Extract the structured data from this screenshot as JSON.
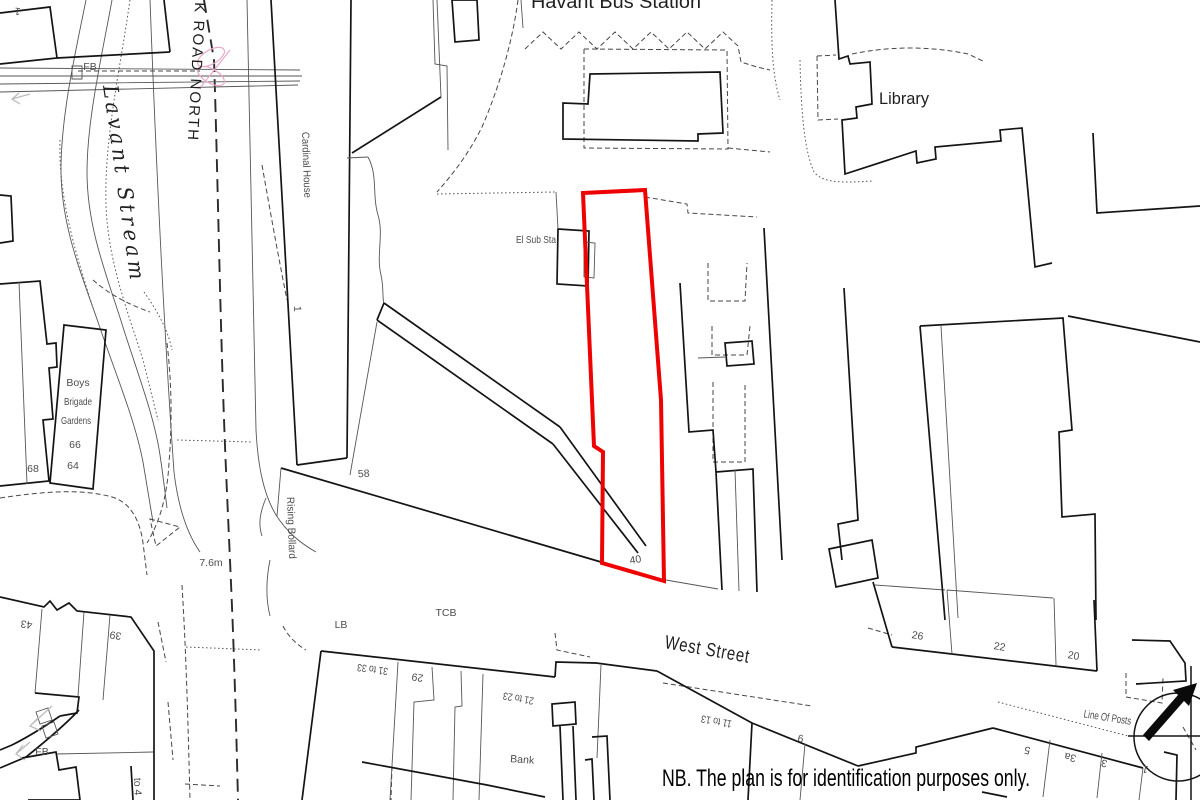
{
  "map": {
    "site_boundary_color": "#ee0202",
    "labels": [
      {
        "id": "havant-bus-station",
        "text": "Havant Bus Station",
        "x": 616,
        "y": 8,
        "size": 19,
        "cls": "lg",
        "tl": 170
      },
      {
        "id": "library",
        "text": "Library",
        "x": 879,
        "y": 104,
        "size": 17,
        "anchor": "start",
        "cls": "lg",
        "tl": 50
      },
      {
        "id": "park-road-north",
        "text": "PARK ROAD NORTH",
        "x": 197,
        "y": -34,
        "rot": 93,
        "size": 15,
        "anchor": "start",
        "cls": "lg",
        "ls": 2,
        "tl": 176
      },
      {
        "id": "lavant-stream",
        "text": "Lavant Stream",
        "x": 103,
        "y": 86,
        "rot": 82,
        "size": 21,
        "anchor": "start",
        "cls": "serif-it",
        "ls": 4,
        "tl": 200
      },
      {
        "id": "fb-top",
        "text": "FB",
        "x": 90,
        "y": 70,
        "size": 10.5
      },
      {
        "id": "top-1",
        "text": "1",
        "x": 18,
        "y": 8,
        "rot": 188,
        "size": 10.5
      },
      {
        "id": "cardinal-house",
        "text": "Cardinal House",
        "x": 302,
        "y": 132,
        "rot": 88,
        "size": 10.5,
        "anchor": "start",
        "tl": 66
      },
      {
        "id": "cardinal-1",
        "text": "1",
        "x": 294,
        "y": 306,
        "rot": 88,
        "size": 10.5,
        "anchor": "start"
      },
      {
        "id": "el-sub-sta",
        "text": "El Sub Sta",
        "x": 556,
        "y": 243,
        "size": 10.5,
        "anchor": "end",
        "tl": 40
      },
      {
        "id": "boys",
        "text": "Boys",
        "x": 78,
        "y": 386,
        "size": 10.5
      },
      {
        "id": "brigade",
        "text": "Brigade",
        "x": 78,
        "y": 405,
        "size": 10.5,
        "tl": 28
      },
      {
        "id": "gardens",
        "text": "Gardens",
        "x": 76,
        "y": 424,
        "size": 10.5,
        "tl": 30
      },
      {
        "id": "n66",
        "text": "66",
        "x": 75,
        "y": 448,
        "size": 10.5
      },
      {
        "id": "n64",
        "text": "64",
        "x": 73,
        "y": 469,
        "size": 10.5
      },
      {
        "id": "n68",
        "text": "68",
        "x": 33,
        "y": 472,
        "size": 10.5
      },
      {
        "id": "n58",
        "text": "58",
        "x": 364,
        "y": 477,
        "rot": -4,
        "size": 10.5
      },
      {
        "id": "bench-76m",
        "text": "7.6m",
        "x": 211,
        "y": 566,
        "size": 10.5
      },
      {
        "id": "rising-bollard",
        "text": "Rising Bollard",
        "x": 287,
        "y": 497,
        "rot": 88,
        "size": 10.5,
        "anchor": "start",
        "tl": 62
      },
      {
        "id": "tcb",
        "text": "TCB",
        "x": 446,
        "y": 616,
        "size": 10.5
      },
      {
        "id": "lb",
        "text": "LB",
        "x": 341,
        "y": 628,
        "size": 10.5
      },
      {
        "id": "n40",
        "text": "40",
        "x": 636,
        "y": 563,
        "rot": -10,
        "size": 10.5
      },
      {
        "id": "west-street",
        "text": "West Street",
        "x": 664,
        "y": 648,
        "rot": 10,
        "size": 19,
        "anchor": "start",
        "cls": "lg",
        "ls": 1,
        "tl": 86
      },
      {
        "id": "n31-33",
        "text": "31 to 33",
        "x": 373,
        "y": 666,
        "rot": 188,
        "size": 10.5,
        "tl": 31
      },
      {
        "id": "n29",
        "text": "29",
        "x": 418,
        "y": 674,
        "rot": 188,
        "size": 10.5
      },
      {
        "id": "n21-23",
        "text": "21 to 23",
        "x": 519,
        "y": 695,
        "rot": 190,
        "size": 10.5,
        "tl": 31
      },
      {
        "id": "bank",
        "text": "Bank",
        "x": 522,
        "y": 763,
        "rot": 4,
        "size": 10.5
      },
      {
        "id": "n11-13",
        "text": "11 to 13",
        "x": 717,
        "y": 718,
        "rot": 190,
        "size": 10.5,
        "tl": 31
      },
      {
        "id": "n6",
        "text": "6",
        "x": 800,
        "y": 742,
        "rot": 10,
        "size": 10.5
      },
      {
        "id": "n26",
        "text": "26",
        "x": 917,
        "y": 639,
        "rot": 10,
        "size": 10.5
      },
      {
        "id": "n22",
        "text": "22",
        "x": 999,
        "y": 650,
        "rot": 10,
        "size": 10.5
      },
      {
        "id": "n20",
        "text": "20",
        "x": 1073,
        "y": 659,
        "rot": 10,
        "size": 10.5
      },
      {
        "id": "line-of-posts",
        "text": "Line Of Posts",
        "x": 1107,
        "y": 721,
        "rot": 9,
        "size": 11,
        "tl": 48
      },
      {
        "id": "n5",
        "text": "5",
        "x": 1028,
        "y": 747,
        "rot": 193,
        "size": 10.5
      },
      {
        "id": "n3a",
        "text": "3a",
        "x": 1071,
        "y": 754,
        "rot": 193,
        "size": 10.5
      },
      {
        "id": "n3",
        "text": "3",
        "x": 1105,
        "y": 760,
        "rot": 193,
        "size": 10.5
      },
      {
        "id": "n1",
        "text": "1",
        "x": 1146,
        "y": 766,
        "rot": 193,
        "size": 10.5
      },
      {
        "id": "n43",
        "text": "43",
        "x": 27,
        "y": 621,
        "rot": 188,
        "size": 10.5
      },
      {
        "id": "n39",
        "text": "39",
        "x": 116,
        "y": 632,
        "rot": 188,
        "size": 10.5
      },
      {
        "id": "fb-bottom",
        "text": "FB",
        "x": 42,
        "y": 755,
        "size": 10.5
      },
      {
        "id": "to4",
        "text": "to 4",
        "x": 134,
        "y": 778,
        "rot": 88,
        "size": 10.5,
        "anchor": "start"
      },
      {
        "id": "plan-note",
        "text": "NB. The plan is for identification purposes only.",
        "x": 662,
        "y": 786,
        "size": 24,
        "anchor": "start",
        "cls": "note",
        "tl": 368
      }
    ]
  }
}
